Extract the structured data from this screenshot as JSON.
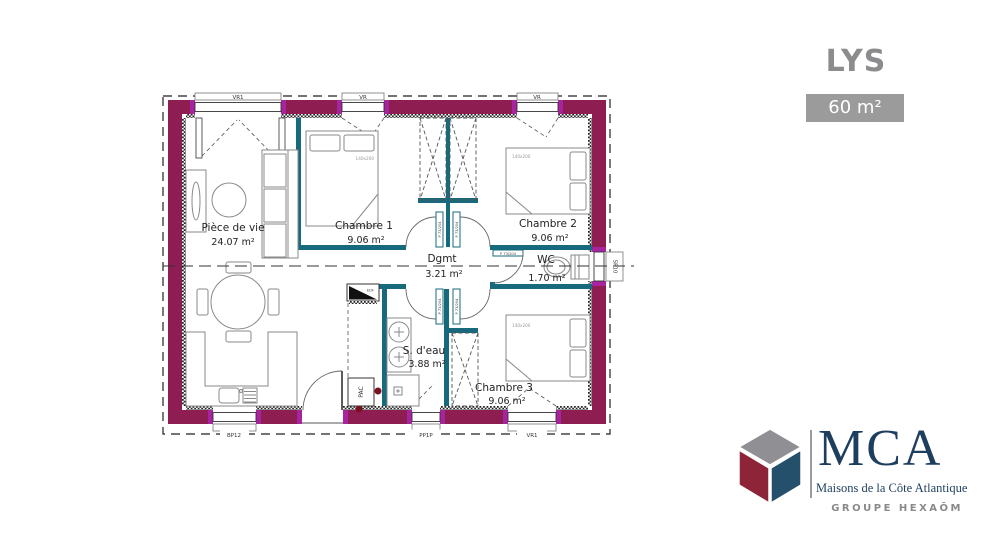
{
  "header": {
    "model_name": "LYS",
    "surface": "60 m²"
  },
  "rooms": {
    "piece_de_vie": {
      "name": "Pièce de vie",
      "area": "24.07 m²"
    },
    "chambre1": {
      "name": "Chambre 1",
      "area": "9.06 m²"
    },
    "chambre2": {
      "name": "Chambre 2",
      "area": "9.06 m²"
    },
    "degagement": {
      "name": "Dgmt",
      "area": "3.21 m²"
    },
    "wc": {
      "name": "WC",
      "area": "1.70 m²"
    },
    "salle_deau": {
      "name": "S. d'eau",
      "area": "3.88 m²"
    },
    "chambre3": {
      "name": "Chambre 3",
      "area": "9.06 m²"
    }
  },
  "labels": {
    "bed_size": "140x200",
    "door": "P 73/204",
    "openings": {
      "top_left": "VR1",
      "top_middle": "VR",
      "top_right": "VR",
      "bottom_left": "BP12",
      "bottom_middle": "PP1P",
      "bottom_right": "VR1",
      "right_side": "SP10"
    },
    "equipment": {
      "electrical": "EDF",
      "heat_pump": "PAC"
    }
  },
  "branding": {
    "logo_text": "MCA",
    "tagline": "Maisons de la Côte Atlantique",
    "group": "GROUPE HEXAŌM"
  },
  "colors": {
    "exterior_wall": "#8e1d52",
    "interior_wall": "#17697c",
    "accent_magenta": "#a823a0",
    "brand_navy": "#1d3e5e",
    "brand_burgundy": "#8e2438",
    "brand_gray": "#909094",
    "title_gray": "#8c8c8e",
    "badge_bg": "#9b9b9b"
  }
}
